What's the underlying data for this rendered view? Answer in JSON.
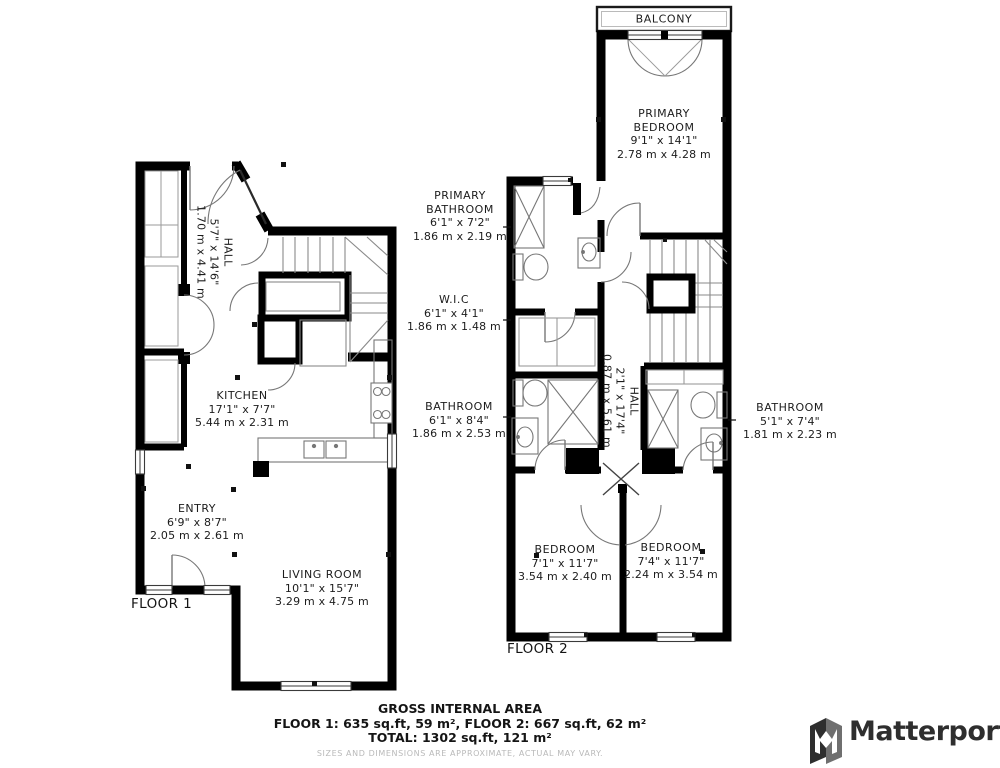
{
  "document_type": "floor-plan",
  "floor1": {
    "label": "FLOOR 1",
    "rooms": {
      "hall": {
        "name": "HALL",
        "imperial": "5'7\" x 14'6\"",
        "metric": "1.70 m x 4.41 m"
      },
      "kitchen": {
        "name": "KITCHEN",
        "imperial": "17'1\" x 7'7\"",
        "metric": "5.44 m x 2.31 m"
      },
      "entry": {
        "name": "ENTRY",
        "imperial": "6'9\" x 8'7\"",
        "metric": "2.05 m x 2.61 m"
      },
      "living_room": {
        "name": "LIVING ROOM",
        "imperial": "10'1\" x 15'7\"",
        "metric": "3.29 m x 4.75 m"
      }
    }
  },
  "floor2": {
    "label": "FLOOR 2",
    "balcony_label": "BALCONY",
    "rooms": {
      "primary_bedroom": {
        "name": "PRIMARY BEDROOM",
        "imperial": "9'1\" x 14'1\"",
        "metric": "2.78 m x 4.28 m"
      },
      "primary_bathroom": {
        "name": "PRIMARY BATHROOM",
        "imperial": "6'1\" x 7'2\"",
        "metric": "1.86 m x 2.19 m"
      },
      "wic": {
        "name": "W.I.C",
        "imperial": "6'1\" x 4'1\"",
        "metric": "1.86 m x 1.48 m"
      },
      "bathroom_left": {
        "name": "BATHROOM",
        "imperial": "6'1\" x 8'4\"",
        "metric": "1.86 m x 2.53 m"
      },
      "bathroom_right": {
        "name": "BATHROOM",
        "imperial": "5'1\" x 7'4\"",
        "metric": "1.81 m x 2.23 m"
      },
      "hall": {
        "name": "HALL",
        "imperial": "2'1\" x 17'4\"",
        "metric": "0.87 m x 5.61 m"
      },
      "bedroom_left": {
        "name": "BEDROOM",
        "imperial": "7'1\" x 11'7\"",
        "metric": "3.54 m x 2.40 m"
      },
      "bedroom_right": {
        "name": "BEDROOM",
        "imperial": "7'4\" x 11'7\"",
        "metric": "2.24 m x 3.54 m"
      }
    }
  },
  "footer": {
    "title": "GROSS INTERNAL AREA",
    "line1": "FLOOR 1: 635 sq.ft, 59 m², FLOOR 2: 667 sq.ft, 62 m²",
    "line2": "TOTAL: 1302 sq.ft, 121 m²",
    "disclaimer": "SIZES AND DIMENSIONS ARE APPROXIMATE, ACTUAL MAY VARY."
  },
  "branding": {
    "logo_text": "Matterport"
  },
  "colors": {
    "wall": "#000000",
    "fixture_line": "#777777",
    "text": "#1c1c1c",
    "disclaimer": "#b9b9b9",
    "logo": "#2e2e2e"
  }
}
